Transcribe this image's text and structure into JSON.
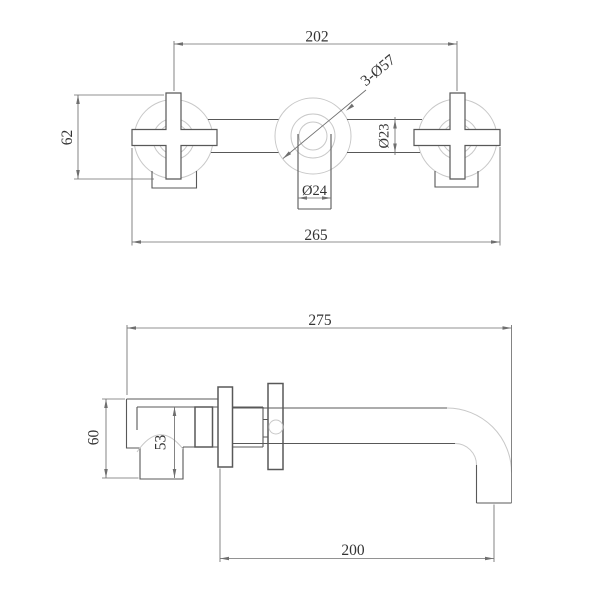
{
  "drawing": {
    "type": "technical-dimension-drawing",
    "subject": "wall-mounted basin mixer faucet, two orthographic views",
    "front_view": {
      "name": "front elevation",
      "label_202": "202",
      "label_62": "62",
      "label_3_57": "3-Ø57",
      "label_23": "Ø23",
      "label_24": "Ø24",
      "label_265": "265"
    },
    "side_view": {
      "name": "side elevation",
      "label_275": "275",
      "label_60": "60",
      "label_53": "53",
      "label_200": "200"
    }
  },
  "colors": {
    "line_dark": "#585858",
    "line_light": "#c8c8c8",
    "line_dim": "#6f6f6f",
    "text": "#333333",
    "background": "#ffffff"
  }
}
